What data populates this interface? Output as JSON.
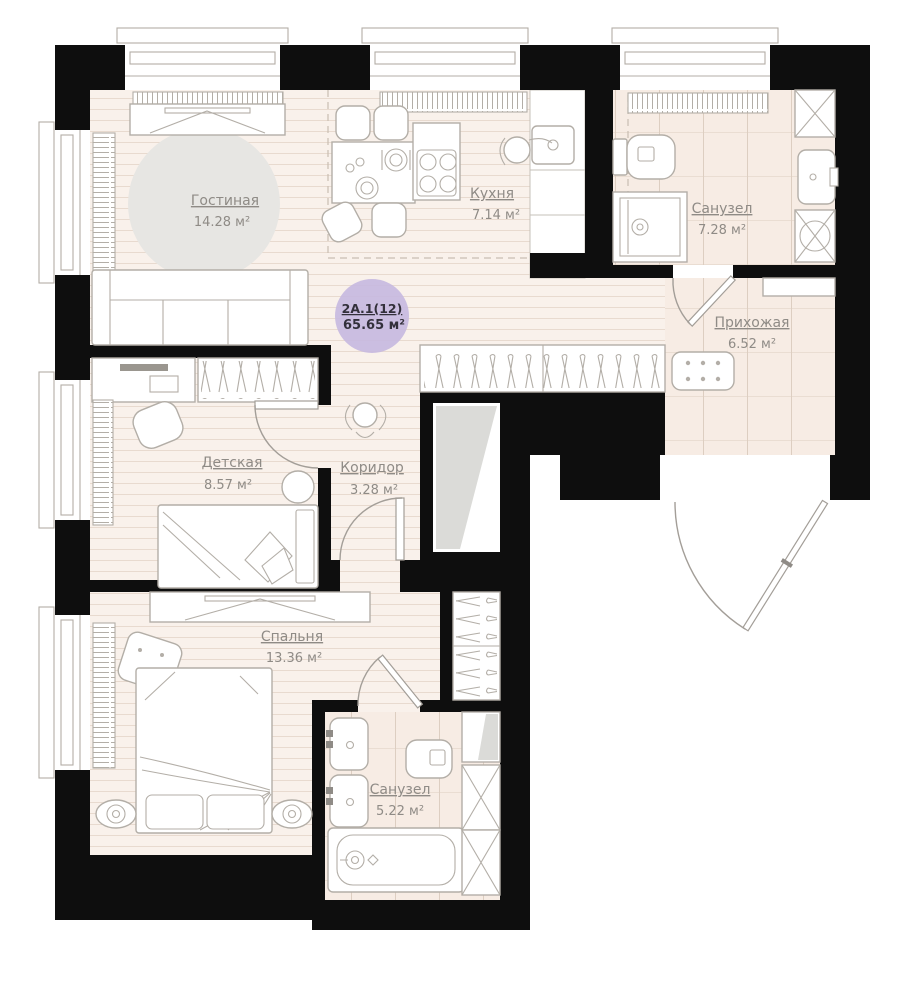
{
  "unit": {
    "code": "2А.1(12)",
    "area": "65.65 м²"
  },
  "rooms": {
    "living": {
      "name": "Гостиная",
      "area": "14.28 м²"
    },
    "kitchen": {
      "name": "Кухня",
      "area": "7.14 м²"
    },
    "bath1": {
      "name": "Санузел",
      "area": "7.28 м²"
    },
    "hall": {
      "name": "Прихожая",
      "area": "6.52 м²"
    },
    "kids": {
      "name": "Детская",
      "area": "8.57 м²"
    },
    "corridor": {
      "name": "Коридор",
      "area": "3.28 м²"
    },
    "bedroom": {
      "name": "Спальня",
      "area": "13.36 м²"
    },
    "bath2": {
      "name": "Санузел",
      "area": "5.22 м²"
    }
  },
  "colors": {
    "wall": "#0e0e0e",
    "wood_floor": "#f9f1eb",
    "tile_floor": "#f7ece4",
    "furniture_stroke": "#b3aea7",
    "rug": "#e7e6e3",
    "unit_badge": "#c7badf",
    "label_text": "#8f8b86"
  }
}
